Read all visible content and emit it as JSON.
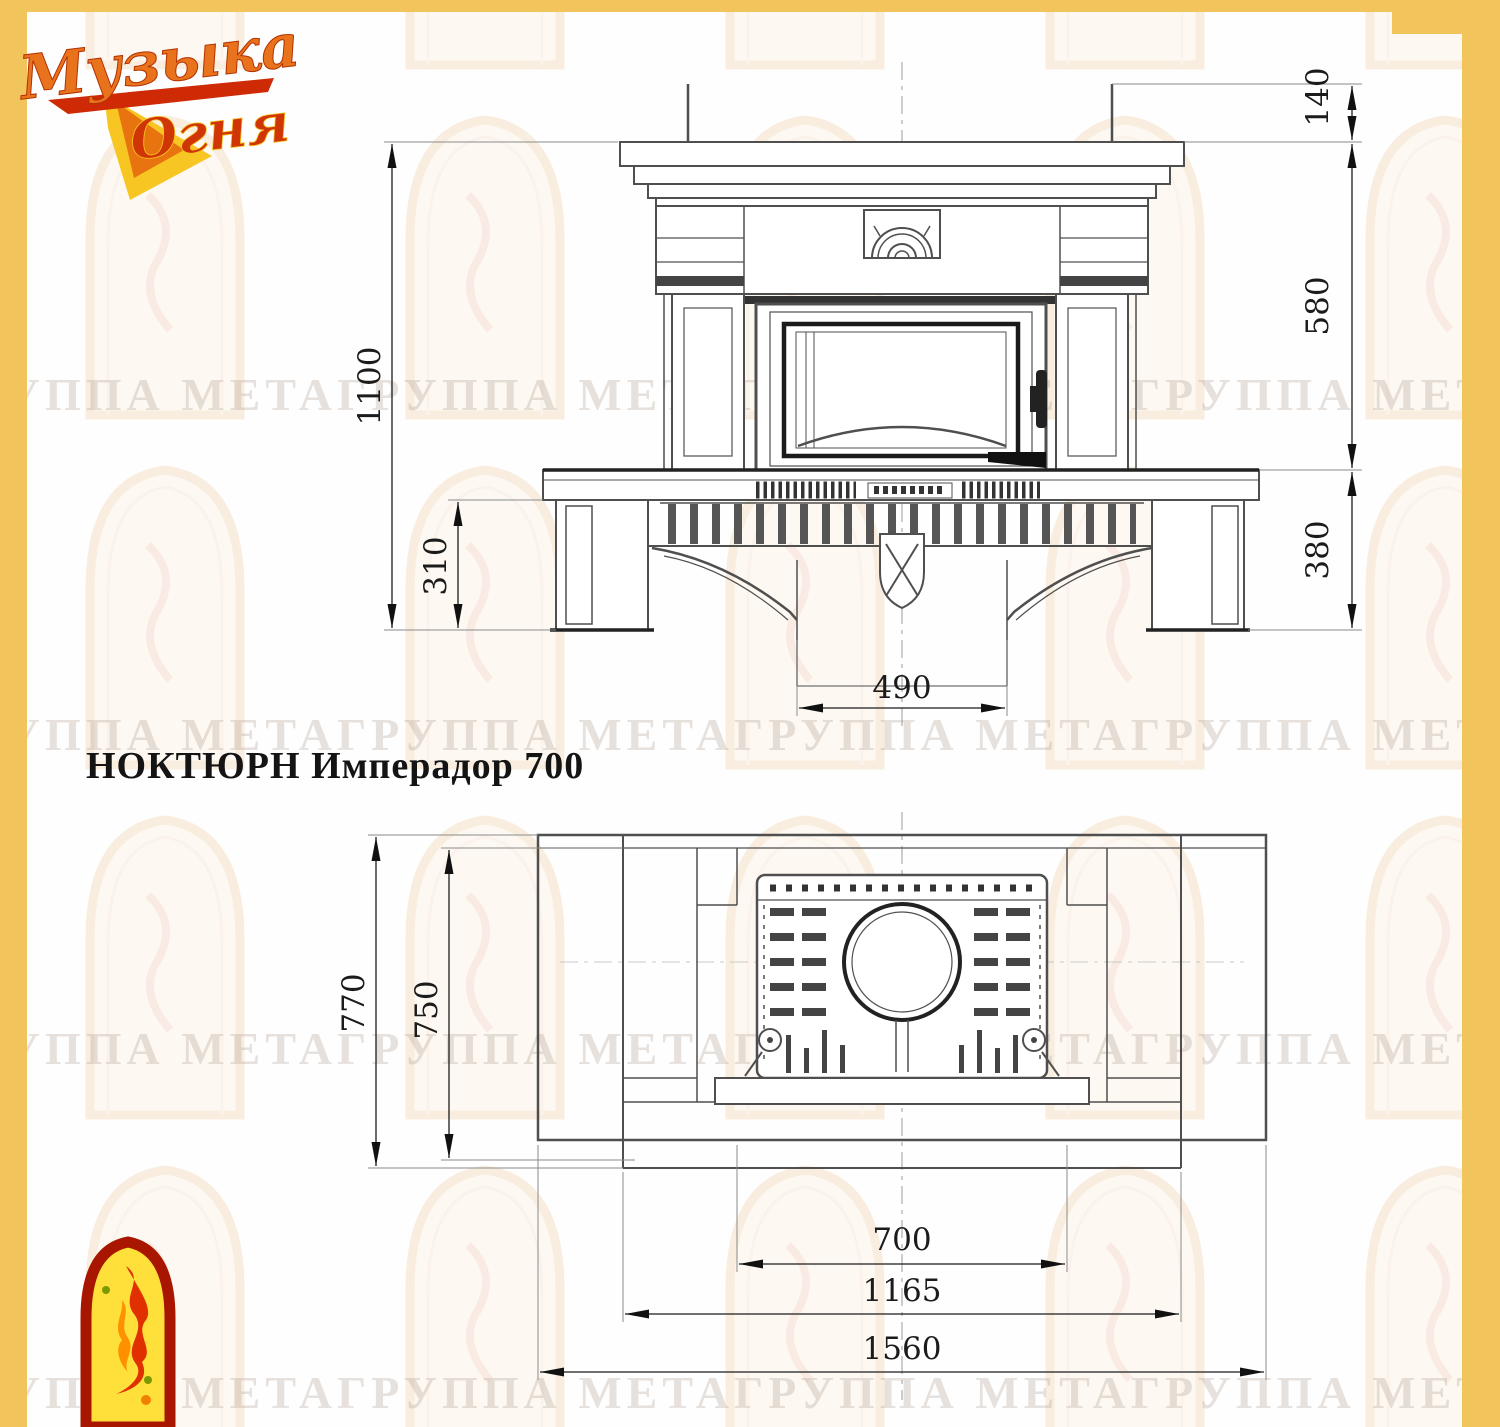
{
  "page": {
    "background": "#fefefe",
    "border_color": "#f2c45c",
    "line_color": "#4f4f4f"
  },
  "logo": {
    "line1": "Музыка",
    "line2": "Огня"
  },
  "title": "НОКТЮРН Имперадор 700",
  "watermark": {
    "row_text": "ГРУППА МЕТАГРУППА МЕТАГРУППА МЕТАГРУППА МЕТАГРУППА МЕТА"
  },
  "front_view": {
    "label": "front elevation of fireplace",
    "dims": {
      "total_height": "1100",
      "base_height": "310",
      "crown_height": "140",
      "middle_height": "580",
      "bench_height": "380",
      "plinth_width": "490"
    }
  },
  "plan_view": {
    "label": "top plan view of fireplace",
    "dims": {
      "depth_outer": "770",
      "depth_inner": "750",
      "firebox_width": "700",
      "inner_width": "1165",
      "total_width": "1560"
    }
  }
}
